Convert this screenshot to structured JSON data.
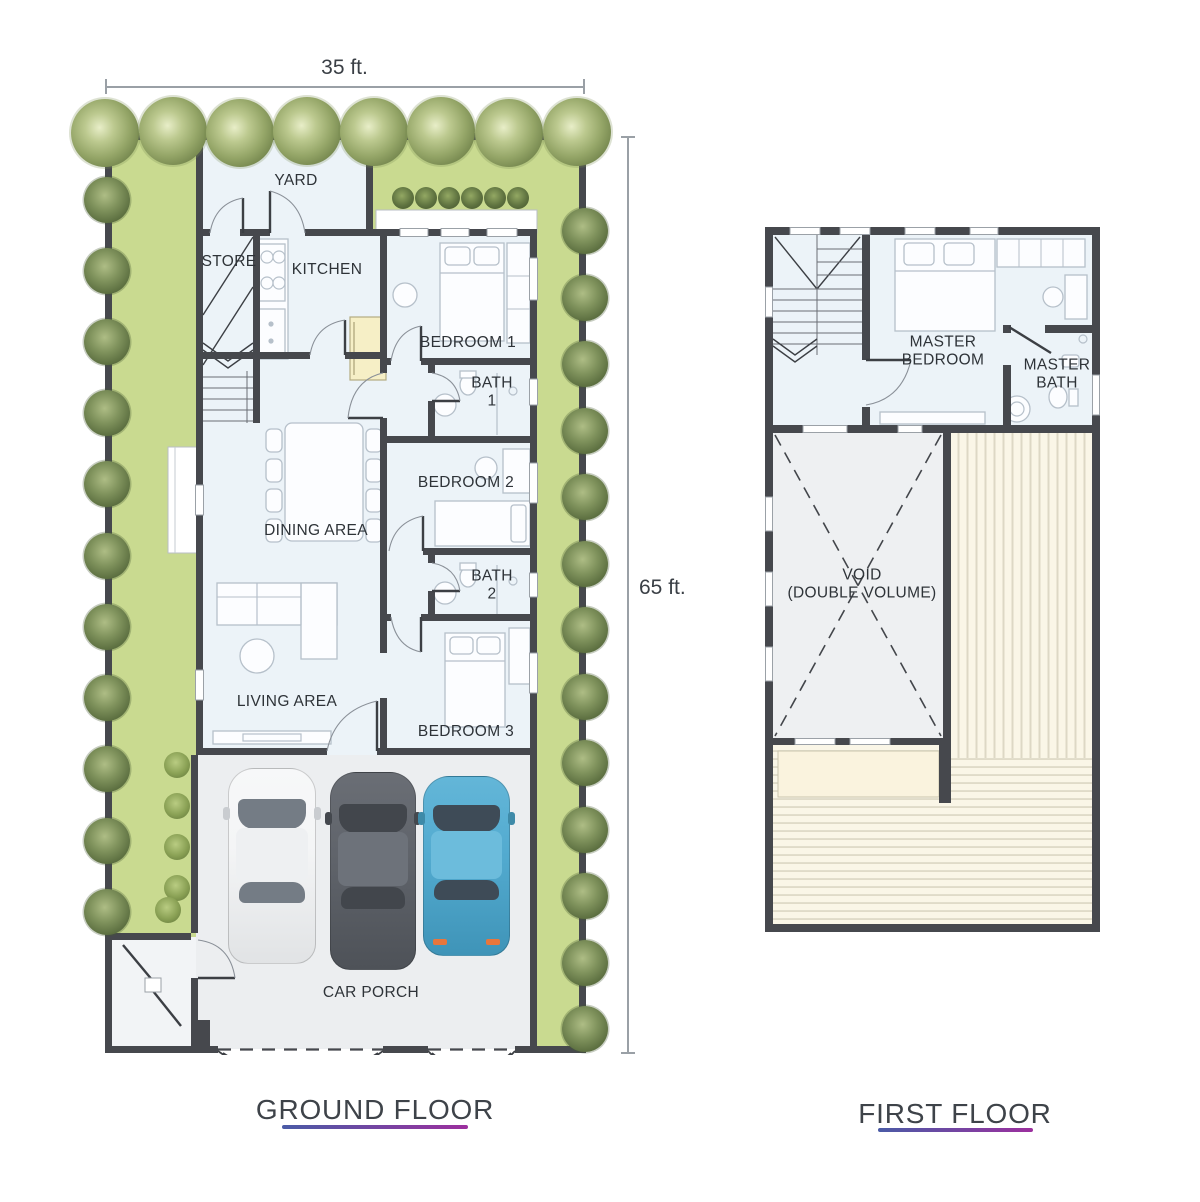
{
  "dimensions": {
    "width_label": "35 ft.",
    "height_label": "65 ft."
  },
  "floors": {
    "ground": {
      "title": "GROUND FLOOR",
      "rooms": {
        "yard": "YARD",
        "store": "STORE",
        "kitchen": "KITCHEN",
        "bedroom1": "BEDROOM 1",
        "bath1": "BATH\n1",
        "bedroom2": "BEDROOM 2",
        "dining": "DINING AREA",
        "bath2": "BATH\n2",
        "living": "LIVING AREA",
        "bedroom3": "BEDROOM 3",
        "carporch": "CAR PORCH"
      }
    },
    "first": {
      "title": "FIRST FLOOR",
      "rooms": {
        "master_bedroom": "MASTER\nBEDROOM",
        "master_bath": "MASTER\nBATH",
        "void": "VOID\n(DOUBLE VOLUME)"
      }
    }
  },
  "colors": {
    "lawn": "#c9da90",
    "floor": "#ecf3f8",
    "wall": "#46484d",
    "porch": "#eceef0",
    "void": "#eef0f2",
    "cream": "#faf3de",
    "deck": "#faf6e7",
    "deck_line": "#ddd8c5",
    "accent_start": "#4a5ba6",
    "accent_end": "#9c2f9e",
    "text": "#2e3338",
    "dim": "#9aa0a6",
    "car_white": "#f4f5f6",
    "car_gray": "#5f636a",
    "car_blue": "#52aacf"
  }
}
